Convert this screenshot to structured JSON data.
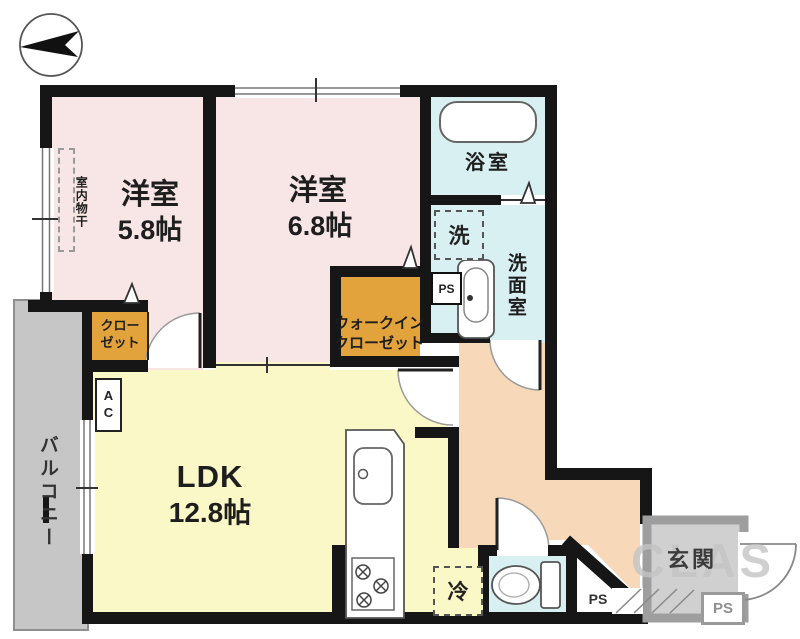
{
  "watermark": "CLAS",
  "rooms": {
    "bedroom1": {
      "name": "洋室",
      "size": "5.8帖"
    },
    "bedroom2": {
      "name": "洋室",
      "size": "6.8帖"
    },
    "ldk": {
      "name": "LDK",
      "size": "12.8帖"
    },
    "bathroom": {
      "name": "浴室"
    },
    "washroom": {
      "name": "洗面室"
    },
    "walk_in_closet": {
      "line1": "ウォークイン",
      "line2": "クローゼット"
    },
    "closet": {
      "line1": "クロー",
      "line2": "ゼット"
    },
    "balcony": {
      "name": "バルコニー"
    },
    "entrance": {
      "name": "玄関"
    }
  },
  "labels": {
    "washer": "洗",
    "refrigerator": "冷",
    "air_conditioner": "AC",
    "indoor_drying": "室内物干",
    "pipe_space_washroom": "PS",
    "pipe_space_toilet": "PS",
    "pipe_space_entrance": "PS"
  },
  "colors": {
    "bedroom": "#F8E6E6",
    "ldk": "#FAF8C6",
    "wet_area": "#D8F0F1",
    "closet": "#E2A33C",
    "hall": "#F7D9BA",
    "balcony": "#C6C6C6",
    "entrance_floor": "#D0D0D0",
    "wall": "#161616",
    "watermark": "#C4C4C4"
  }
}
